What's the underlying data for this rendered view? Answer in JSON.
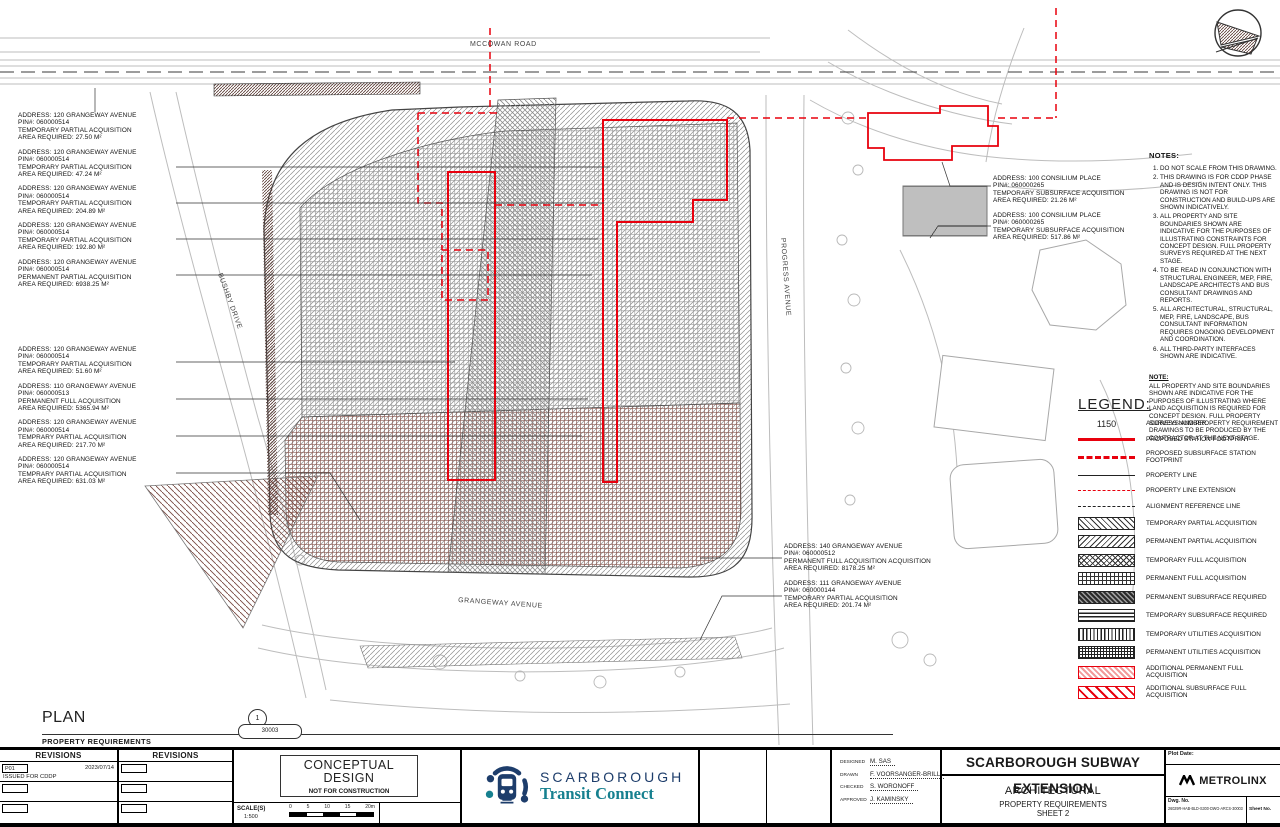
{
  "streets": {
    "mccowan": "MCCOWAN ROAD",
    "bushby": "BUSHBY DRIVE",
    "progress": "PROGRESS AVENUE",
    "grangeway": "GRANGEWAY AVENUE"
  },
  "labels_left_a": [
    {
      "lines": [
        "ADDRESS: 120 GRANGEWAY AVENUE",
        "PIN#: 060000514",
        "TEMPORARY PARTIAL ACQUISITION",
        "AREA REQUIRED: 27.50 m²"
      ]
    },
    {
      "lines": [
        "ADDRESS: 120 GRANGEWAY AVENUE",
        "PIN#: 060000514",
        "TEMPORARY PARTIAL ACQUISITION",
        "AREA REQUIRED: 47.24 m²"
      ]
    },
    {
      "lines": [
        "ADDRESS: 120 GRANGEWAY AVENUE",
        "PIN#: 060000514",
        "TEMPORARY PARTIAL ACQUISITION",
        "AREA REQUIRED: 204.89 m²"
      ]
    },
    {
      "lines": [
        "ADDRESS: 120 GRANGEWAY AVENUE",
        "PIN#: 060000514",
        "TEMPORARY PARTIAL ACQUISITION",
        "AREA REQUIRED: 192.80 m²"
      ]
    },
    {
      "lines": [
        "ADDRESS: 120 GRANGEWAY AVENUE",
        "PIN#: 060000514",
        "PERMANENT PARTIAL ACQUISITION",
        "AREA REQUIRED: 6938.25 m²"
      ]
    }
  ],
  "labels_left_b": [
    {
      "lines": [
        "ADDRESS: 120 GRANGEWAY AVENUE",
        "PIN#: 060000514",
        "TEMPORARY PARTIAL ACQUISITION",
        "AREA REQUIRED: 51.60 m²"
      ]
    },
    {
      "lines": [
        "ADDRESS: 110 GRANGEWAY AVENUE",
        "PIN#: 060000513",
        "PERMANENT FULL ACQUISITION",
        "AREA REQUIRED: 5365.94 m²"
      ]
    },
    {
      "lines": [
        "ADDRESS: 120 GRANGEWAY AVENUE",
        "PIN#: 060000514",
        "TEMPRARY PARTIAL ACQUISITION",
        "AREA REQUIRED: 217.70 m²"
      ]
    },
    {
      "lines": [
        "ADDRESS: 120 GRANGEWAY AVENUE",
        "PIN#: 060000514",
        "TEMPRARY PARTIAL ACQUISITION",
        "AREA REQUIRED: 631.03 m²"
      ]
    }
  ],
  "labels_center": [
    {
      "lines": [
        "ADDRESS: 140 GRANGEWAY AVENUE",
        "PIN#: 060000512",
        "PERMANENT FULL ACQUISITION ACQUISITION",
        "AREA REQUIRED: 8178.25 m²"
      ]
    },
    {
      "lines": [
        "ADDRESS: 111 GRANGEWAY AVENUE",
        "PIN#: 060000144",
        "TEMPORARY PARTIAL ACQUISITION",
        "AREA REQUIRED: 201.74 m²"
      ]
    }
  ],
  "labels_right": [
    {
      "lines": [
        "ADDRESS: 100 CONSILIUM PLACE",
        "PIN#: 060000265",
        "TEMPORARY SUBSURFACE ACQUISITION",
        "AREA REQUIRED: 21.26 m²"
      ]
    },
    {
      "lines": [
        "ADDRESS: 100 CONSILIUM PLACE",
        "PIN#: 060000265",
        "TEMPORARY SUBSURFACE ACQUISITION",
        "AREA REQUIRED: 517.86 m²"
      ]
    }
  ],
  "notes": {
    "title": "NOTES:",
    "items": [
      "DO NOT SCALE FROM THIS DRAWING.",
      "THIS DRAWING IS FOR CDDP PHASE AND IS DESIGN INTENT ONLY. THIS DRAWING IS NOT FOR CONSTRUCTION AND BUILD-UPS ARE SHOWN INDICATIVELY.",
      "ALL PROPERTY AND SITE BOUNDARIES SHOWN ARE INDICATIVE FOR THE PURPOSES OF ILLUSTRATING CONSTRAINTS FOR CONCEPT DESIGN. FULL PROPERTY SURVEYS REQUIRED AT THE NEXT STAGE.",
      "TO BE READ IN CONJUNCTION WITH STRUCTURAL ENGINEER, MEP, FIRE, LANDSCAPE ARCHITECTS AND BUS CONSULTANT DRAWINGS AND REPORTS.",
      "ALL ARCHITECTURAL, STRUCTURAL, MEP, FIRE, LANDSCAPE, BUS CONSULTANT INFORMATION REQUIRES ONGOING DEVELOPMENT AND COORDINATION.",
      "ALL THIRD-PARTY INTERFACES SHOWN ARE INDICATIVE."
    ],
    "note2_title": "NOTE:",
    "note2_body": "ALL PROPERTY AND SITE BOUNDARIES SHOWN ARE INDICATIVE FOR THE PURPOSES OF ILLUSTRATING WHERE LAND ACQUISITION IS REQUIRED FOR CONCEPT DESIGN. FULL PROPERTY SURVEYS AND PROPERTY REQUIREMENT DRAWINGS TO BE PRODUCED BY THE CONTRACTOR AT THE NEXT STAGE."
  },
  "legend": {
    "title": "LEGEND:",
    "items": [
      {
        "swatch": "sw-addr",
        "sample": "1150",
        "label": "ADDRESS NUMBER"
      },
      {
        "swatch": "sw-line-red",
        "label": "PROPOSED STATION FOOTPRINT"
      },
      {
        "swatch": "sw-line-red-dash",
        "label": "PROPOSED SUBSURFACE STATION FOOTPRINT"
      },
      {
        "swatch": "sw-line-black",
        "label": "PROPERTY LINE"
      },
      {
        "swatch": "sw-line-red-dash-thin",
        "label": "PROPERTY LINE EXTENSION"
      },
      {
        "swatch": "sw-line-black-dash",
        "label": "ALIGNMENT REFERENCE LINE"
      },
      {
        "swatch": "sw-diagr",
        "label": "TEMPORARY PARTIAL ACQUISITION"
      },
      {
        "swatch": "sw-diagl",
        "label": "PERMANENT PARTIAL ACQUISITION"
      },
      {
        "swatch": "sw-cross",
        "label": "TEMPORARY FULL ACQUISITION"
      },
      {
        "swatch": "sw-grid",
        "label": "PERMANENT FULL ACQUISITION"
      },
      {
        "swatch": "sw-subperm",
        "label": "PERMANENT SUBSURFACE REQUIRED"
      },
      {
        "swatch": "sw-subtemp",
        "label": "TEMPORARY SUBSURFACE REQUIRED"
      },
      {
        "swatch": "sw-vlines",
        "label": "TEMPORARY UTILITIES ACQUISITION"
      },
      {
        "swatch": "sw-utilperm",
        "label": "PERMANENT UTILITIES ACQUISITION"
      },
      {
        "swatch": "sw-redfull",
        "label": "ADDITIONAL PERMANENT FULL ACQUISITION"
      },
      {
        "swatch": "sw-redsub",
        "label": "ADDITIONAL SUBSURFACE FULL ACQUISITION"
      }
    ]
  },
  "caption": {
    "title": "PLAN",
    "subtitle": "PROPERTY REQUIREMENTS",
    "detail_top": "1",
    "detail_bottom": "30003"
  },
  "titleblock": {
    "revisions_header": "REVISIONS",
    "revision_rows": [
      {
        "code": "P01",
        "date": "2023/07/14",
        "desc": "ISSUED FOR CDDP"
      }
    ],
    "stamp_line1": "CONCEPTUAL",
    "stamp_line2": "DESIGN",
    "stamp_line3": "NOT FOR CONSTRUCTION",
    "scale_label": "SCALE(S)",
    "scale_ratio": "1:500",
    "scale_ticks": [
      "0",
      "5",
      "10",
      "15",
      "20m"
    ],
    "logo_line1": "SCARBOROUGH",
    "logo_line2": "Transit Connect",
    "credits": [
      {
        "role": "DESIGNED",
        "name": "M. SAS"
      },
      {
        "role": "DRAWN",
        "name": "F. VOORSANGER-BRILL"
      },
      {
        "role": "CHECKED",
        "name": "S. WORONOFF"
      },
      {
        "role": "APPROVED",
        "name": "J. KAMINSKY"
      }
    ],
    "project": "SCARBOROUGH SUBWAY EXTENSION",
    "discipline": "ARCHITECTURAL",
    "sheet_title1": "PROPERTY REQUIREMENTS",
    "sheet_title2": "SHEET 2",
    "plot_date_label": "Plot Date:",
    "brand": "METROLINX",
    "dwg_label": "Dwg. No.",
    "dwg_no": "26029R-HAB-BLD-S300-DWG-ARCS-30003",
    "sheet_no_label": "Sheet No."
  },
  "colors": {
    "red": "#e8000d",
    "navy": "#1d3d6b",
    "teal": "#16808f"
  }
}
